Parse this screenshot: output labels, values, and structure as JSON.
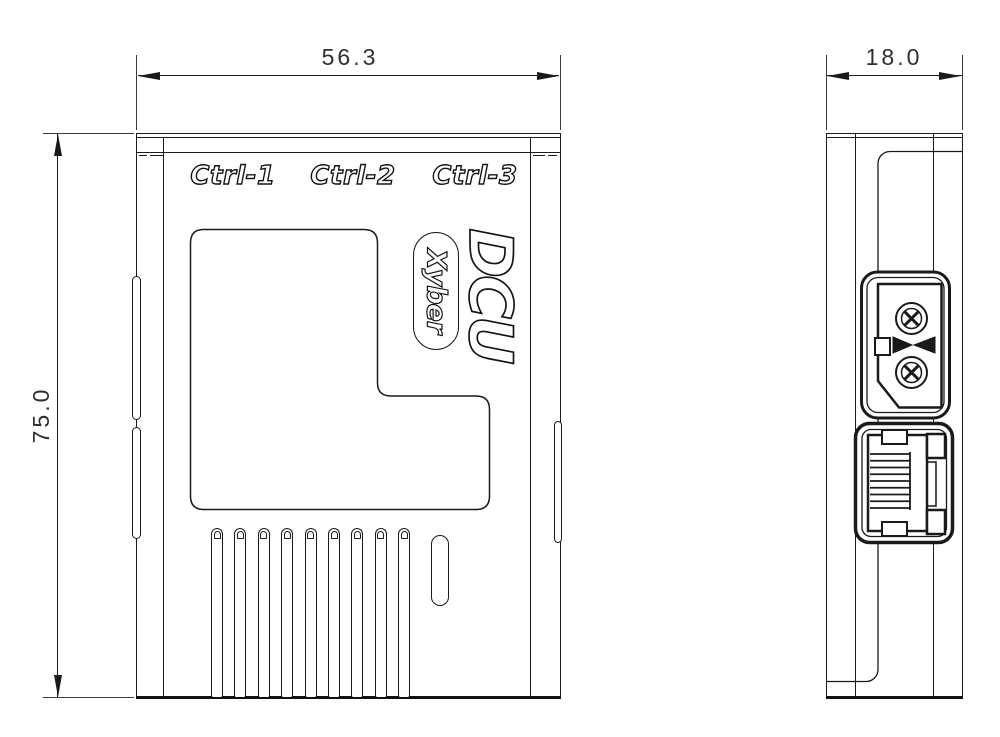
{
  "colors": {
    "background": "#ffffff",
    "line": "#1a1a1a",
    "dim_text": "#2f2f2f"
  },
  "front_view": {
    "port_labels": [
      {
        "label": "Ctrl-1"
      },
      {
        "label": "Ctrl-2"
      },
      {
        "label": "Ctrl-3"
      }
    ],
    "logo_primary": "DCU",
    "logo_secondary": "Xyber",
    "vent_slots": {
      "count": 9
    }
  },
  "side_view": {
    "connectors": [
      {
        "name": "xt30-power-connector"
      },
      {
        "name": "rj45-ethernet-port"
      }
    ]
  },
  "dimensions": {
    "front_width": {
      "label": "56.3"
    },
    "front_height": {
      "label": "75.0"
    },
    "side_depth": {
      "label": "18.0"
    }
  }
}
